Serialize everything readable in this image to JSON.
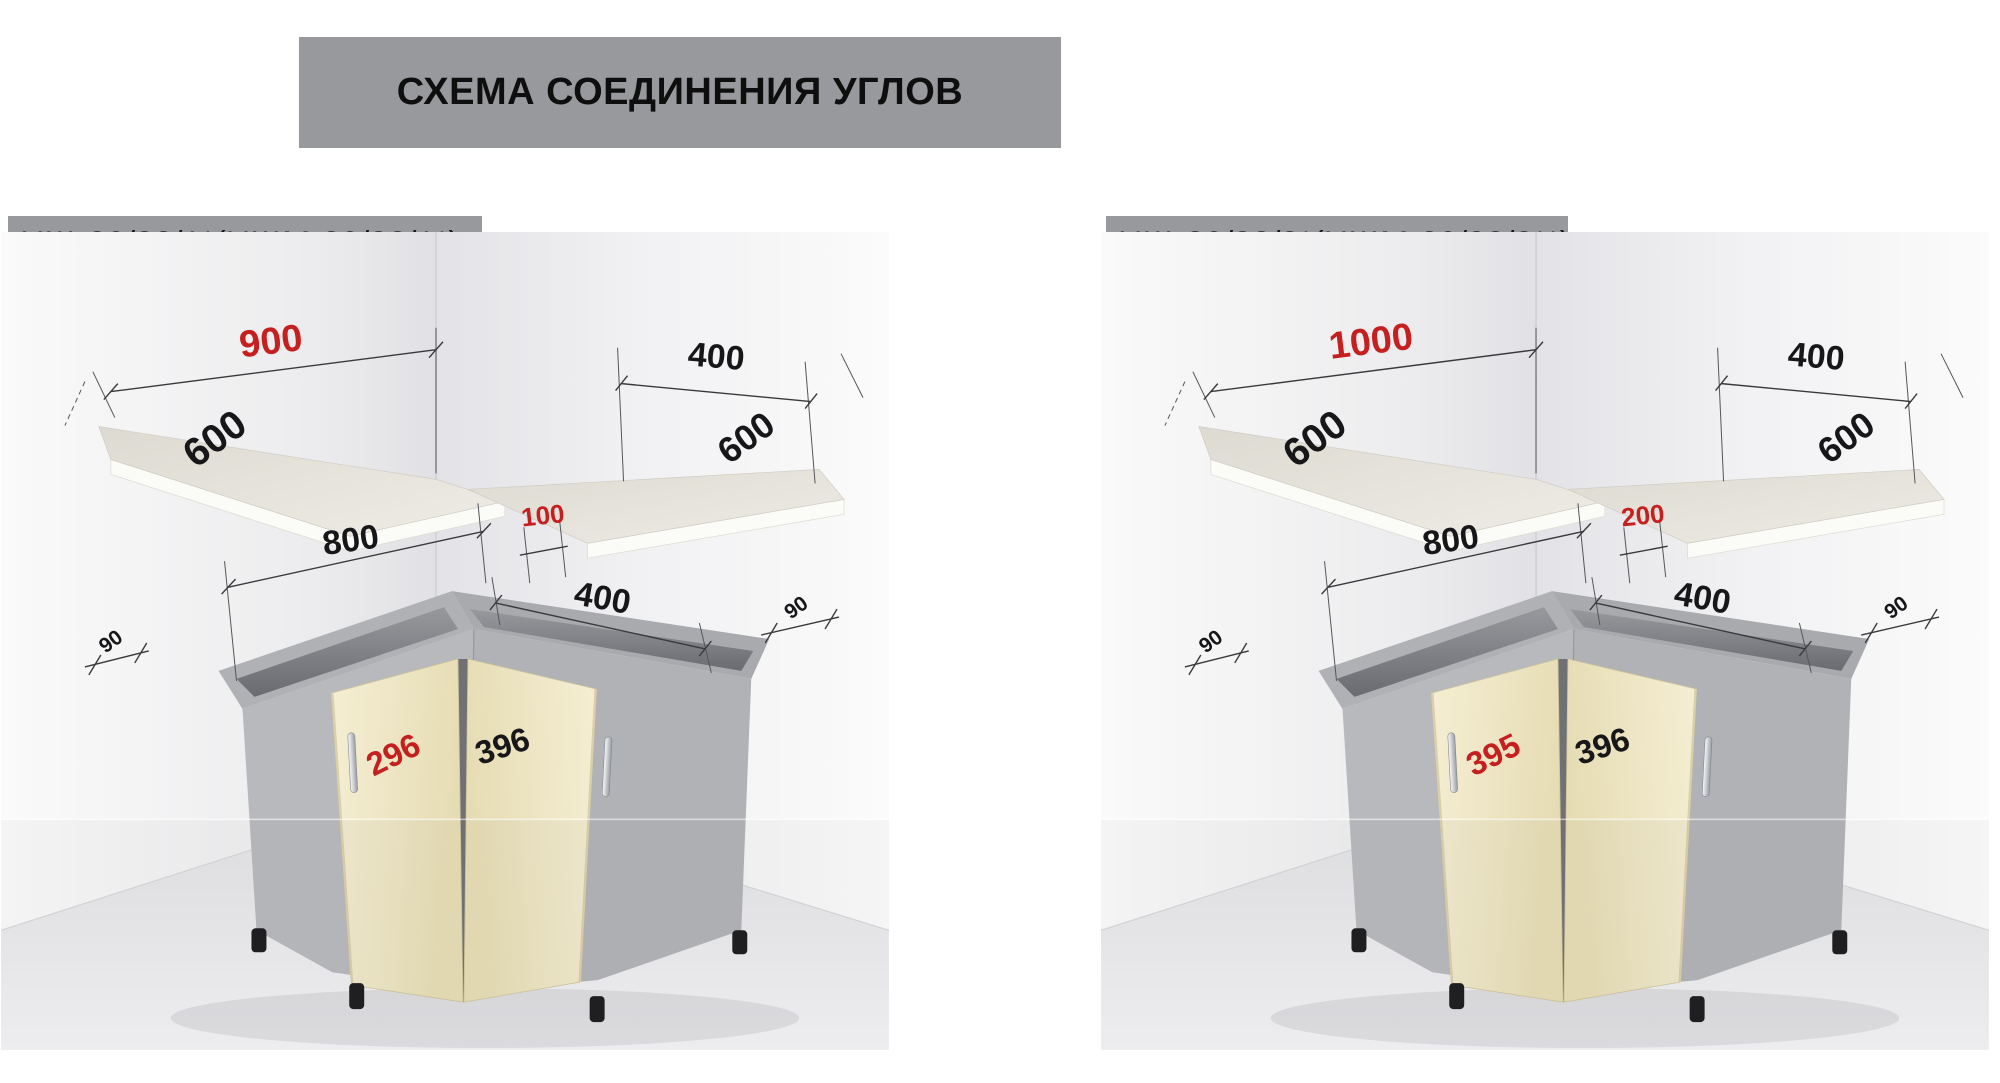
{
  "header": {
    "title": "СХЕМА СОЕДИНЕНИЯ УГЛОВ"
  },
  "colors": {
    "banner_bg": "#98999c",
    "dim_red": "#c51f1f",
    "dim_black": "#17171a",
    "door_cream": "#efe7c3",
    "carcass_gray": "#b3b5b9",
    "worktop": "#e6e4db",
    "worktop_edge": "#fbfbf7"
  },
  "diagrams": [
    {
      "label": "НЩ-80/82/1*(НЩМ-80/82/1*)",
      "dims": {
        "worktop_main_length": "900",
        "worktop_main_depth": "600",
        "worktop_side_length": "400",
        "worktop_side_depth": "600",
        "carcass_main_width": "800",
        "corner_gap": "100",
        "carcass_side_width": "400",
        "wall_clearance_left": "90",
        "wall_clearance_right": "90",
        "door_left_width": "296",
        "door_right_width": "396"
      }
    },
    {
      "label": "НЩ-80/82/2*(НЩМ-80/82/2**)",
      "dims": {
        "worktop_main_length": "1000",
        "worktop_main_depth": "600",
        "worktop_side_length": "400",
        "worktop_side_depth": "600",
        "carcass_main_width": "800",
        "corner_gap": "200",
        "carcass_side_width": "400",
        "wall_clearance_left": "90",
        "wall_clearance_right": "90",
        "door_left_width": "395",
        "door_right_width": "396"
      }
    }
  ]
}
